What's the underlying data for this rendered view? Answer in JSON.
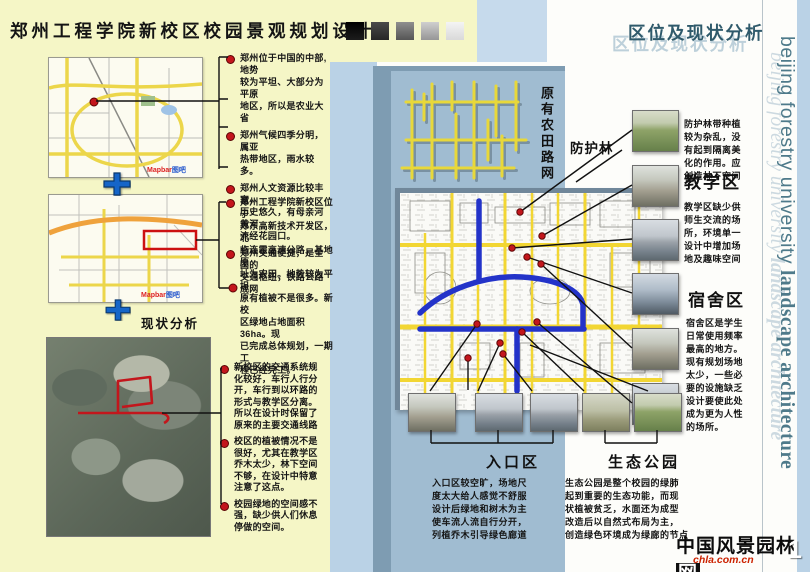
{
  "board": {
    "title": "郑州工程学院新校区校园景观规划设计",
    "section_title": "区位及现状分析",
    "watermark_sans": "beijing forestry university ",
    "watermark_serif": "landscape architecture"
  },
  "left": {
    "location_bullets": [
      "郑州位于中国的中部, 地势\n较为平坦、大部分为平原\n地区，所以是农业大省",
      "郑州气候四季分明，属亚\n热带地区，雨水较多。",
      "郑州人文资源比较丰富，\n历史悠久，有母亲河黄河\n流经花园口。",
      "郑州交通便捷，是全国的\n交通枢纽，铁路公路成网"
    ],
    "campus_text": "郑州工程学院新校区位于\n郑东高新技术开发区，北\n临连霍高速公路，基地原\n址为农田。地势较为平坦\n原有植被不是很多。新校\n区绿地占地面积36ha。现\n已完成总体规划，一期工\n程已经完工。",
    "status_heading": "现状分析",
    "status_bullets": [
      "新校区的交通系统规\n化较好，车行人行分\n开，车行到以环路的\n形式与教学区分离。\n所以在设计时保留了\n原来的主要交通线路",
      "校区的植被情况不是\n很好，尤其在教学区\n乔木太少，林下空间\n不够，在设计中特意\n注意了这点。",
      "校园绿地的空间感不\n强，缺少供人们休息\n停做的空间。"
    ],
    "map_watermark_en": "Mapbar",
    "map_watermark_cn": "图吧"
  },
  "middle": {
    "farm_grid_label": "原有农田路网",
    "shelter_label": "防护林",
    "entrance_label": "入口区",
    "entrance_text": "入口区较空旷，场地尺\n度太大给人感觉不舒服\n设计后绿地和树木为主\n使车流人流自行分开，\n列植乔木引导绿色廊道"
  },
  "right": {
    "shelter_text": "防护林带种植\n较为杂乱，没\n有起到隔离美\n化的作用。应\n创造林下空间",
    "teaching_label": "教学区",
    "teaching_text": "教学区缺少供\n师生交流的场\n所，环境单一\n设计中增加场\n地及趣味空间",
    "dorm_label": "宿舍区",
    "dorm_text": "宿舍区是学生\n日常使用频率\n最高的地方。\n现有规划场地\n太少，一些必\n要的设施缺乏\n设计要使此处\n成为更为人性\n的场所。",
    "eco_label": "生态公园",
    "eco_text": "生态公园是整个校园的绿肺\n起到重要的生态功能，而现\n状植被贫乏，水面还为成型\n改造后以自然式布局为主，\n创造绿色环境成为绿廊的节点"
  },
  "footer": {
    "logo_name_main": "中国风景园林",
    "logo_name_last": "网",
    "logo_url": "chla.com.cn",
    "page_number": "1"
  },
  "colors": {
    "panel_yellow": "#f5f6c6",
    "panel_blue": "#a0bcd1",
    "light_blue": "#bad2e6",
    "road_yellow": "#eed531",
    "water_blue": "#2333c9",
    "marker_red": "#c3161c",
    "teal_text": "#4e7a8a",
    "title_swatches": [
      "#0d0d0d",
      "#3c3c3c",
      "#707070",
      "#ababab",
      "#e9e9e9"
    ]
  }
}
